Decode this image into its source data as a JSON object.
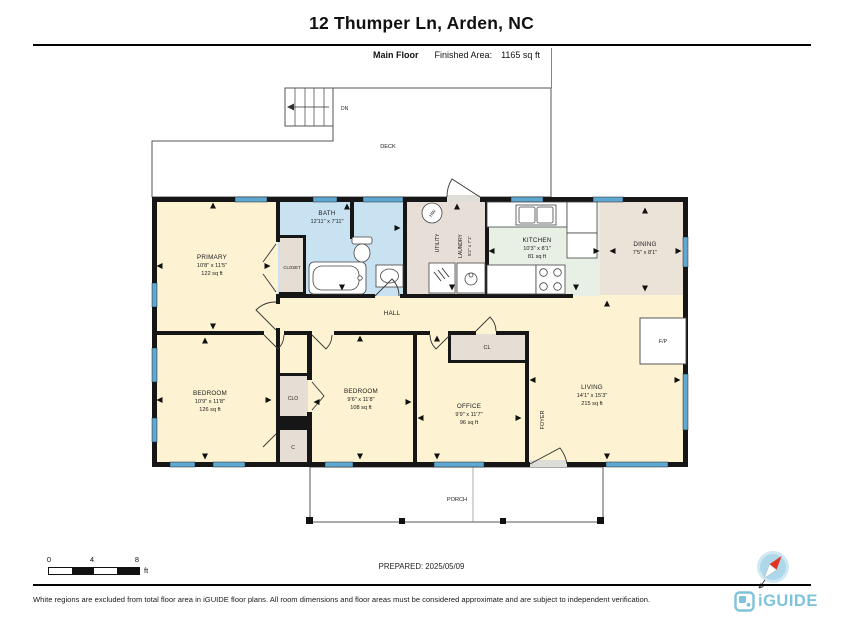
{
  "header": {
    "title": "12 Thumper Ln, Arden, NC",
    "floor_label": "Main Floor",
    "area_label": "Finished Area:",
    "area_value": "1165 sq ft"
  },
  "rooms": {
    "primary": {
      "name": "PRIMARY",
      "dims": "10'8\" x 11'5\"",
      "area": "122 sq ft"
    },
    "bath": {
      "name": "BATH",
      "dims": "12'11\" x 7'11\""
    },
    "closet": {
      "name": "CLOSET"
    },
    "utility": {
      "name": "UTILITY"
    },
    "laundry": {
      "name": "LAUNDRY",
      "dims": "5'2\" x 7'1\""
    },
    "kitchen": {
      "name": "KITCHEN",
      "dims": "10'3\" x 8'1\"",
      "area": "81 sq ft"
    },
    "dining": {
      "name": "DINING",
      "dims": "7'5\" x 8'1\""
    },
    "hall": {
      "name": "HALL"
    },
    "deck": {
      "name": "DECK"
    },
    "stairs": {
      "name": "DN"
    },
    "water_heater": {
      "name": "HW"
    },
    "bedroom1": {
      "name": "BEDROOM",
      "dims": "10'9\" x 11'8\"",
      "area": "126 sq ft"
    },
    "clo": {
      "name": "CLO"
    },
    "c_closet": {
      "name": "C"
    },
    "bedroom2": {
      "name": "BEDROOM",
      "dims": "9'6\" x 11'8\"",
      "area": "108 sq ft"
    },
    "office": {
      "name": "OFFICE",
      "dims": "9'9\" x 11'7\"",
      "area": "96 sq ft"
    },
    "cl": {
      "name": "CL"
    },
    "foyer": {
      "name": "FOYER"
    },
    "living": {
      "name": "LIVING",
      "dims": "14'1\" x 15'3\"",
      "area": "215 sq ft"
    },
    "fireplace": {
      "name": "F/P"
    },
    "porch": {
      "name": "PORCH"
    }
  },
  "scale_bar": {
    "tick0": "0",
    "tick1": "4",
    "tick2": "8",
    "unit": "ft"
  },
  "footer": {
    "prepared": "PREPARED: 2025/05/09",
    "disclaimer": "White regions are excluded from total floor area in iGUIDE floor plans. All room dimensions and floor areas must be considered approximate and are subject to independent verification.",
    "logo_text": "iGUIDE"
  },
  "colors": {
    "room_cream": "#fdf2d2",
    "bath_blue": "#c9e2f2",
    "utility_taupe": "#e7dfd7",
    "kitchen_green": "#e8efe4",
    "dining_taupe": "#ece3d8",
    "closet_taupe": "#e6ded5",
    "window_blue": "#5ea8d2",
    "wall_black": "#161616",
    "logo_blue": "#7ec3dc",
    "compass_red": "#e23323"
  }
}
